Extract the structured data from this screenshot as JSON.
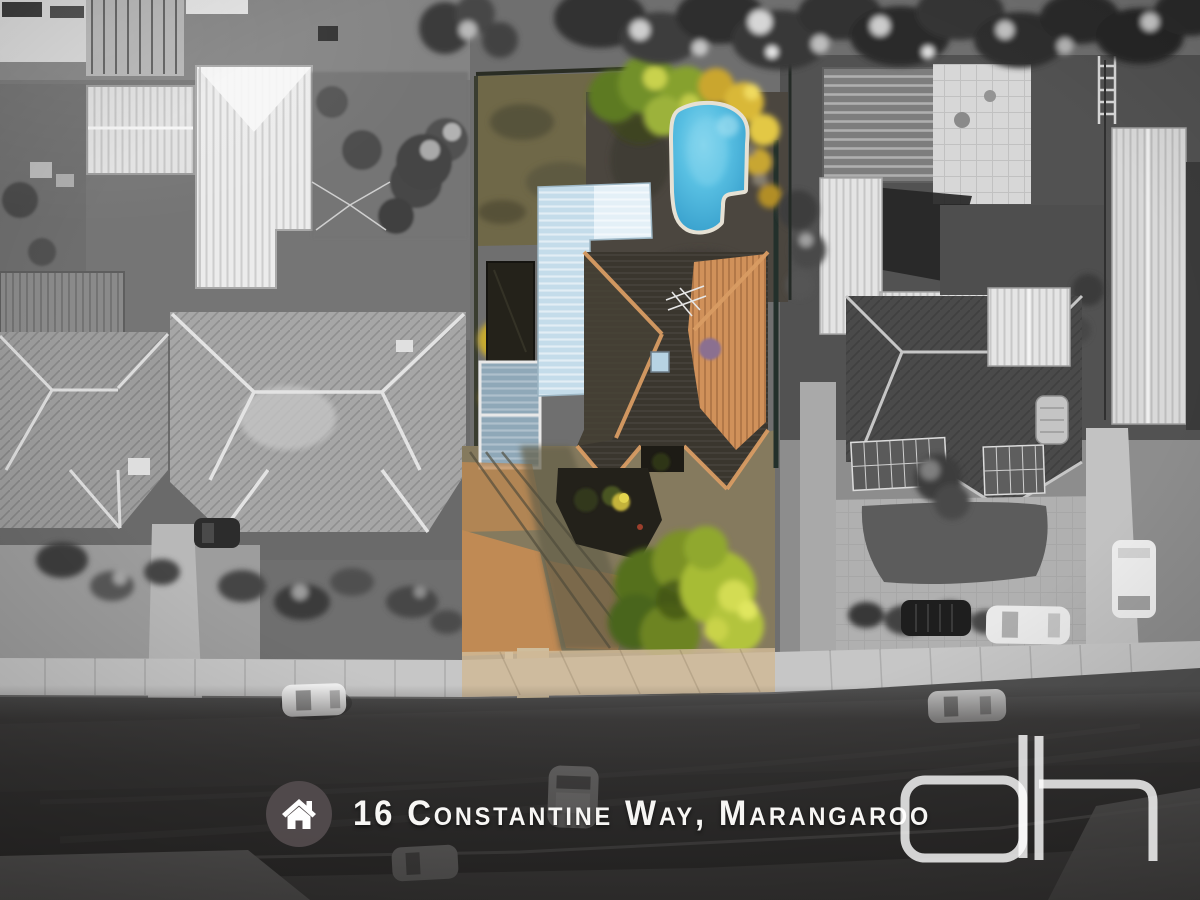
{
  "scene": {
    "description": "Aerial drone photo of suburban lot, subject property in color, surroundings black and white",
    "subject_features": [
      "backyard pool",
      "tiled hip roof",
      "light blue patio roof",
      "front lawn tree"
    ]
  },
  "caption": {
    "address": "16 Constantine Way, Marangaroo",
    "icon": "home-icon"
  },
  "branding": {
    "logo": "dh-logo",
    "letters": "dh"
  },
  "colors": {
    "pool_water": "#45b4dd",
    "roof_sunlit": "#d0915a",
    "roof_dark": "#3a362e",
    "tree_green": "#a8bc3a",
    "lawn_gold": "#c08a54",
    "patio_blue": "#c4dcea",
    "caption_text": "#f7f6f4",
    "icon_circle": "#524b4d",
    "logo_white": "#ffffff"
  }
}
